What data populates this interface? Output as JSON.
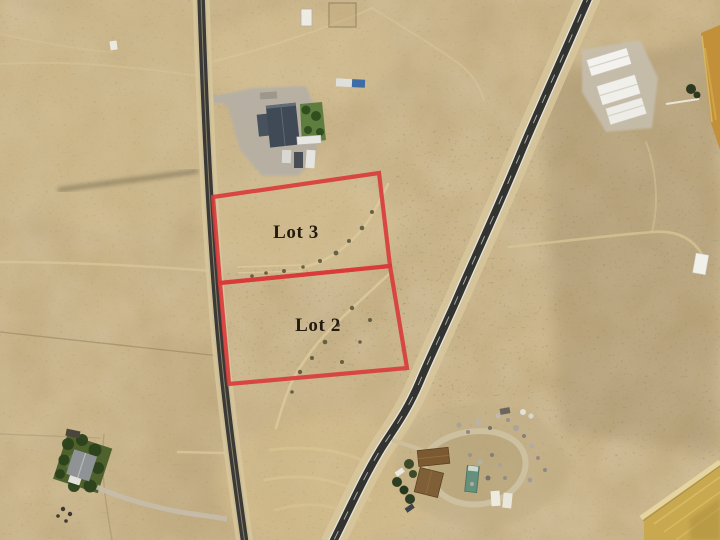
{
  "scene": {
    "lots": [
      {
        "id": "lot-3",
        "label": "Lot 3"
      },
      {
        "id": "lot-2",
        "label": "Lot 2"
      }
    ],
    "colors": {
      "boundary": "#d93a3a",
      "label": "#241b0f",
      "terrain": "#c6ac7d",
      "asphalt": "#3a3936",
      "highway_asphalt": "#333330",
      "shoulder": "#d7c69c",
      "field_gold": "#c8a94f",
      "field_gold_top": "#c29038",
      "lawn": "#5f7d3e",
      "gravel": "#b6b0a4"
    }
  }
}
